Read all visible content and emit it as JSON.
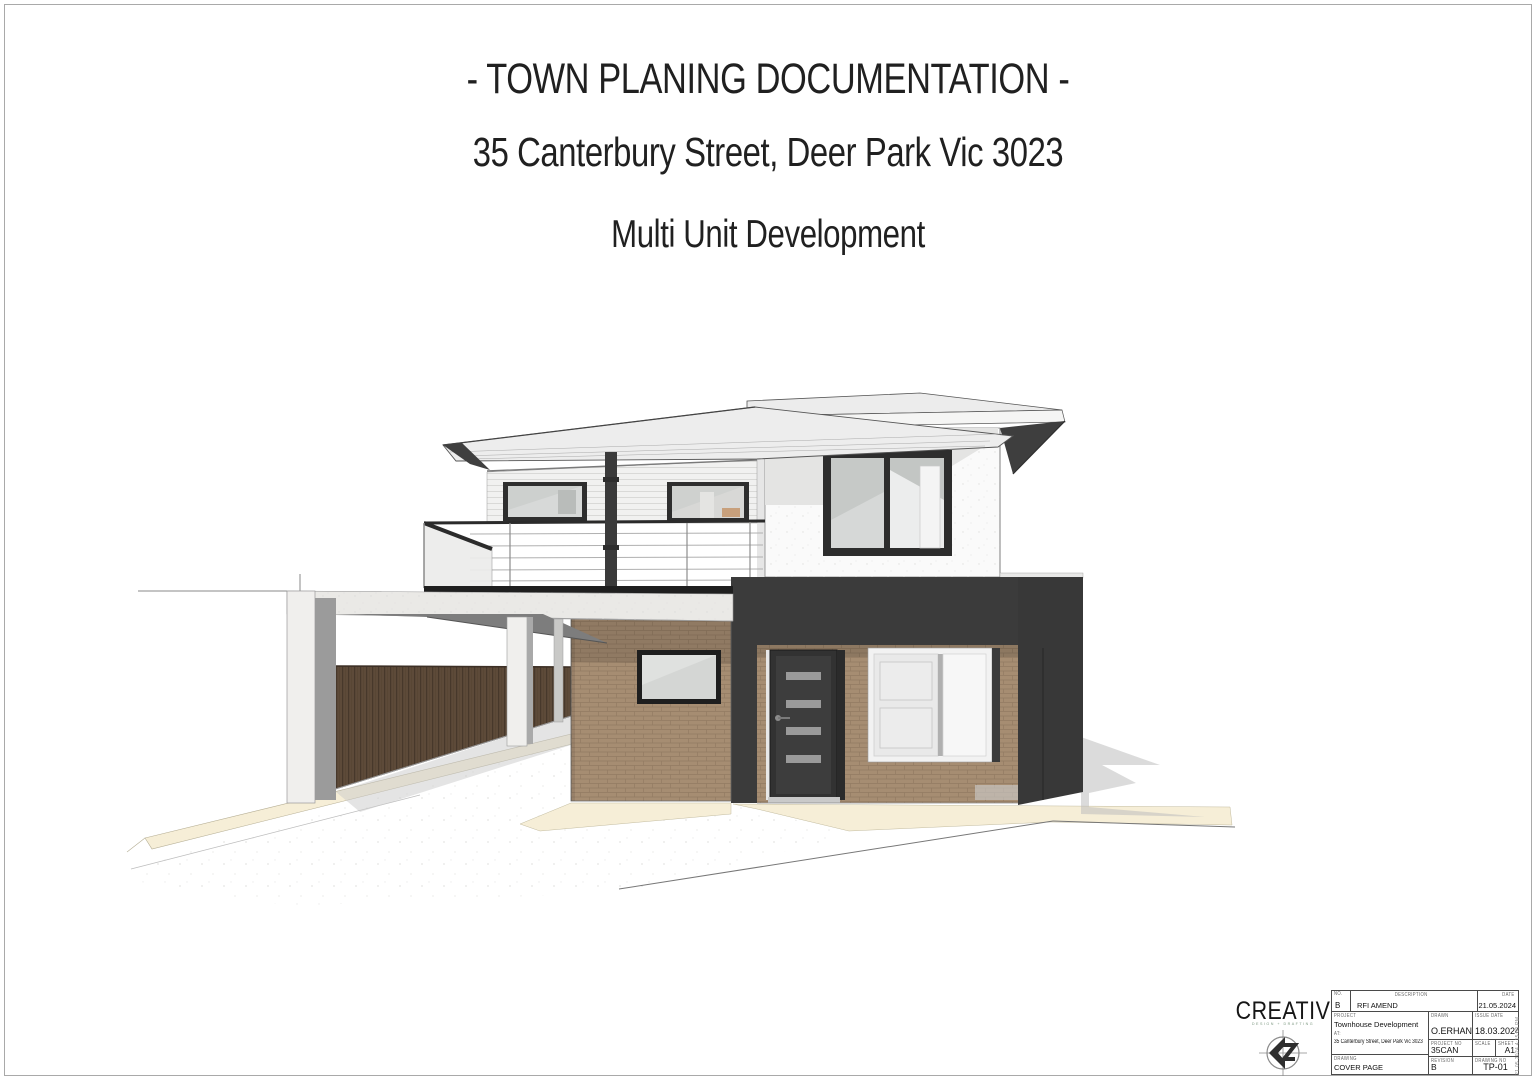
{
  "header": {
    "line1": "- TOWN PLANING DOCUMENTATION -",
    "line2": "35 Canterbury Street, Deer Park Vic 3023",
    "line3": "Multi Unit Development"
  },
  "logo": {
    "name": "CREATIV",
    "tagline": "DESIGN + DRAFTING"
  },
  "titleblock": {
    "revision_table": {
      "no_label": "No.",
      "description_label": "Description",
      "date_label": "Date",
      "row": {
        "no": "B",
        "description": "RFI AMEND",
        "date": "21.05.2024"
      }
    },
    "project_label": "PROJECT",
    "project_name": "Townhouse Development",
    "at_label": "AT:",
    "project_address": "35 Canterbury Street, Deer Park Vic 3023",
    "drawn_label": "DRAWN",
    "drawn_value": "O.ERHAN",
    "issue_date_label": "ISSUE DATE",
    "issue_date_value": "18.03.2024",
    "project_no_label": "PROJECT NO",
    "project_no_value": "35CAN",
    "scale_label": "SCALE",
    "scale_value": "",
    "sheet_label": "SHEET",
    "sheet_value": "A1",
    "drawing_label": "DRAWING",
    "drawing_value": "COVER PAGE",
    "revision_label": "REVISION",
    "revision_value": "B",
    "drawing_no_label": "DRAWING NO",
    "drawing_no_value": "TP-01"
  },
  "plot_stamp": "21.05.2024 4:15:09 PM",
  "palette": {
    "charcoal_cladding": "#3b3b3b",
    "brick": "#a68d72",
    "timber_fence": "#5d4a39",
    "concrete": "#eae9e6",
    "cream_path": "#f6eed7",
    "window_frame_dark": "#2d2d2d",
    "roof_metal": "#ececec"
  }
}
